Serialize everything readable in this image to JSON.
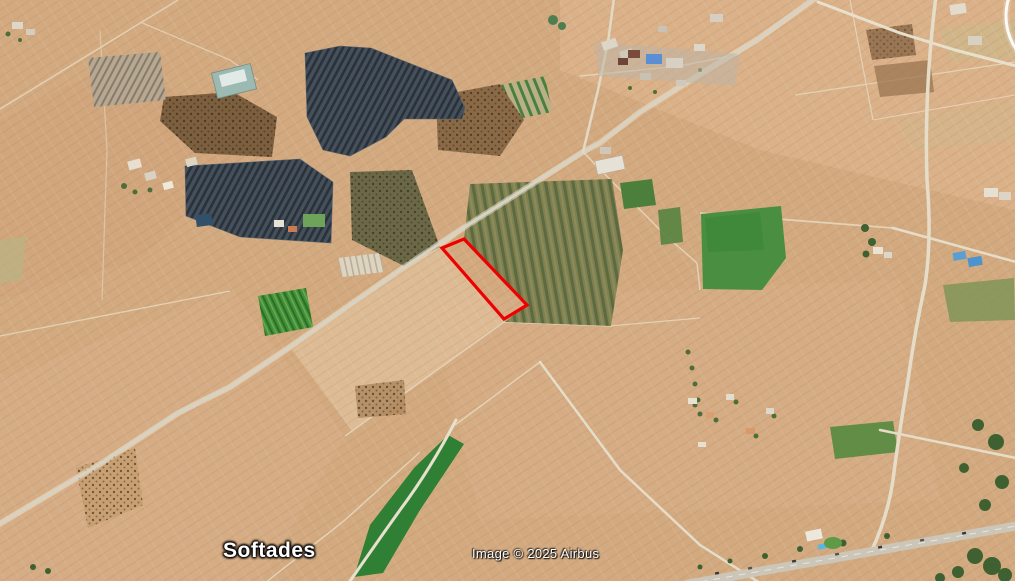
{
  "map": {
    "view": "satellite-aerial-imagery",
    "place_label": "Softades",
    "attribution": "Image © 2025 Airbus",
    "highlighted_parcel": {
      "label": "selected-parcel",
      "outline_color": "#ee0000",
      "points": "442,248 464,239 527,305 504,319"
    },
    "palette": {
      "terrain": "#d3aa80",
      "terrain_light": "#e5c9a4",
      "road": "#ddd5c2",
      "highway": "#ccc6b8",
      "crop_olive": "#7c814f",
      "crop_green": "#4a8f41",
      "crop_dark_green": "#2f8034",
      "solar_panels": "#45505b",
      "orchard_brown": "#7c5f3e",
      "label_text": "#ffffff"
    },
    "features": [
      {
        "name": "solar-farm-north",
        "kind": "solar-array"
      },
      {
        "name": "solar-farm-south",
        "kind": "solar-array"
      },
      {
        "name": "olive-crop-field-center",
        "kind": "field"
      },
      {
        "name": "green-crop-field-east",
        "kind": "field"
      },
      {
        "name": "green-strip-field-south",
        "kind": "field"
      },
      {
        "name": "orchard-patches",
        "kind": "orchard"
      },
      {
        "name": "highlighted-parcel",
        "kind": "parcel-outline"
      },
      {
        "name": "main-road-diagonal",
        "kind": "road"
      },
      {
        "name": "highway-southeast",
        "kind": "road"
      },
      {
        "name": "village-label-softades",
        "kind": "place-label"
      }
    ]
  }
}
